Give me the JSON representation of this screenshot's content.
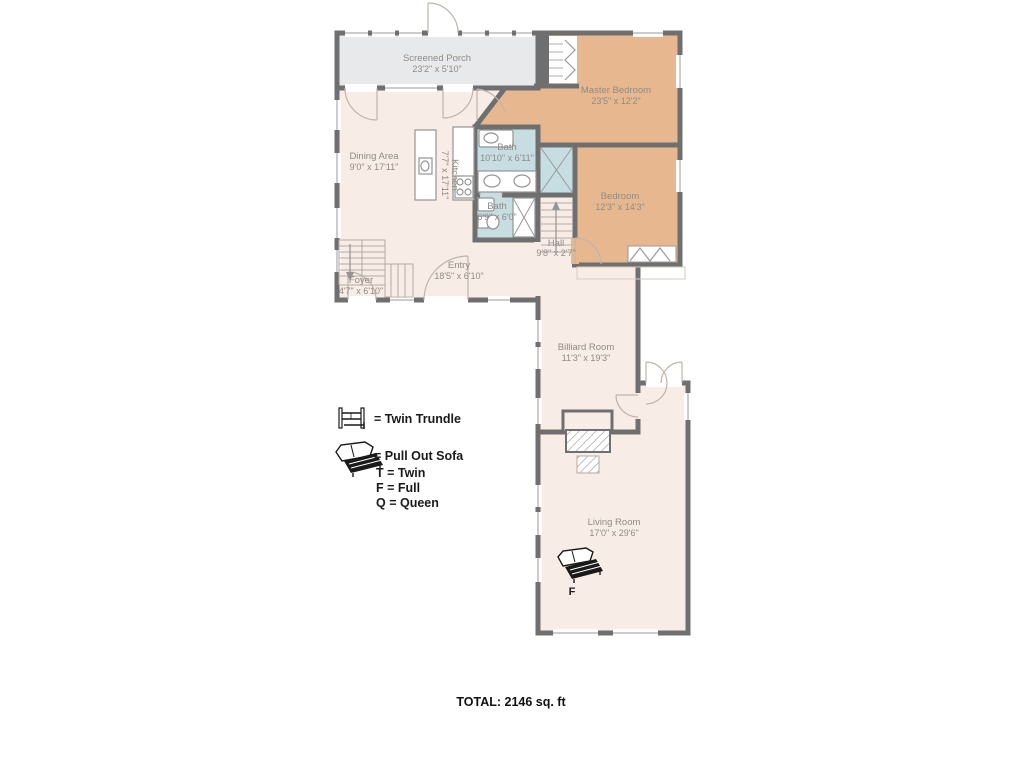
{
  "palette": {
    "wall": "#6f6f6f",
    "room_cream": "#f8ece6",
    "room_tan": "#e7b88f",
    "room_blue": "#c6dde2",
    "porch_gray": "#e8e9ea",
    "label_text": "#8f8b86",
    "legend_text": "#1a1a1a"
  },
  "rooms": [
    {
      "name": "Screened Porch",
      "dims": "23'2\" x 5'10\""
    },
    {
      "name": "Master Bedroom",
      "dims": "23'5\" x 12'2\""
    },
    {
      "name": "Dining Area",
      "dims": "9'0\" x 17'11\""
    },
    {
      "name": "Kitchen",
      "dims": "7'7\" x 17'11\""
    },
    {
      "name": "Bath",
      "dims": "10'10\" x 6'11\""
    },
    {
      "name": "Bath",
      "dims": "6'9\" x 6'0\""
    },
    {
      "name": "Bedroom",
      "dims": "12'3\" x 14'3\""
    },
    {
      "name": "Hall",
      "dims": "9'8\" x 2'7\""
    },
    {
      "name": "Entry",
      "dims": "18'5\" x 6'10\""
    },
    {
      "name": "Foyer",
      "dims": "4'7\" x 6'10\""
    },
    {
      "name": "Billiard Room",
      "dims": "11'3\" x 19'3\""
    },
    {
      "name": "Living Room",
      "dims": "17'0\" x 29'6\""
    }
  ],
  "legend": {
    "twin_trundle": "= Twin Trundle",
    "pull_out_sofa": "= Pull Out Sofa",
    "twin": "T = Twin",
    "full": "F = Full",
    "queen": "Q = Queen"
  },
  "annotations": {
    "sofa_label": "F"
  },
  "footer": {
    "total": "TOTAL: 2146 sq. ft"
  }
}
